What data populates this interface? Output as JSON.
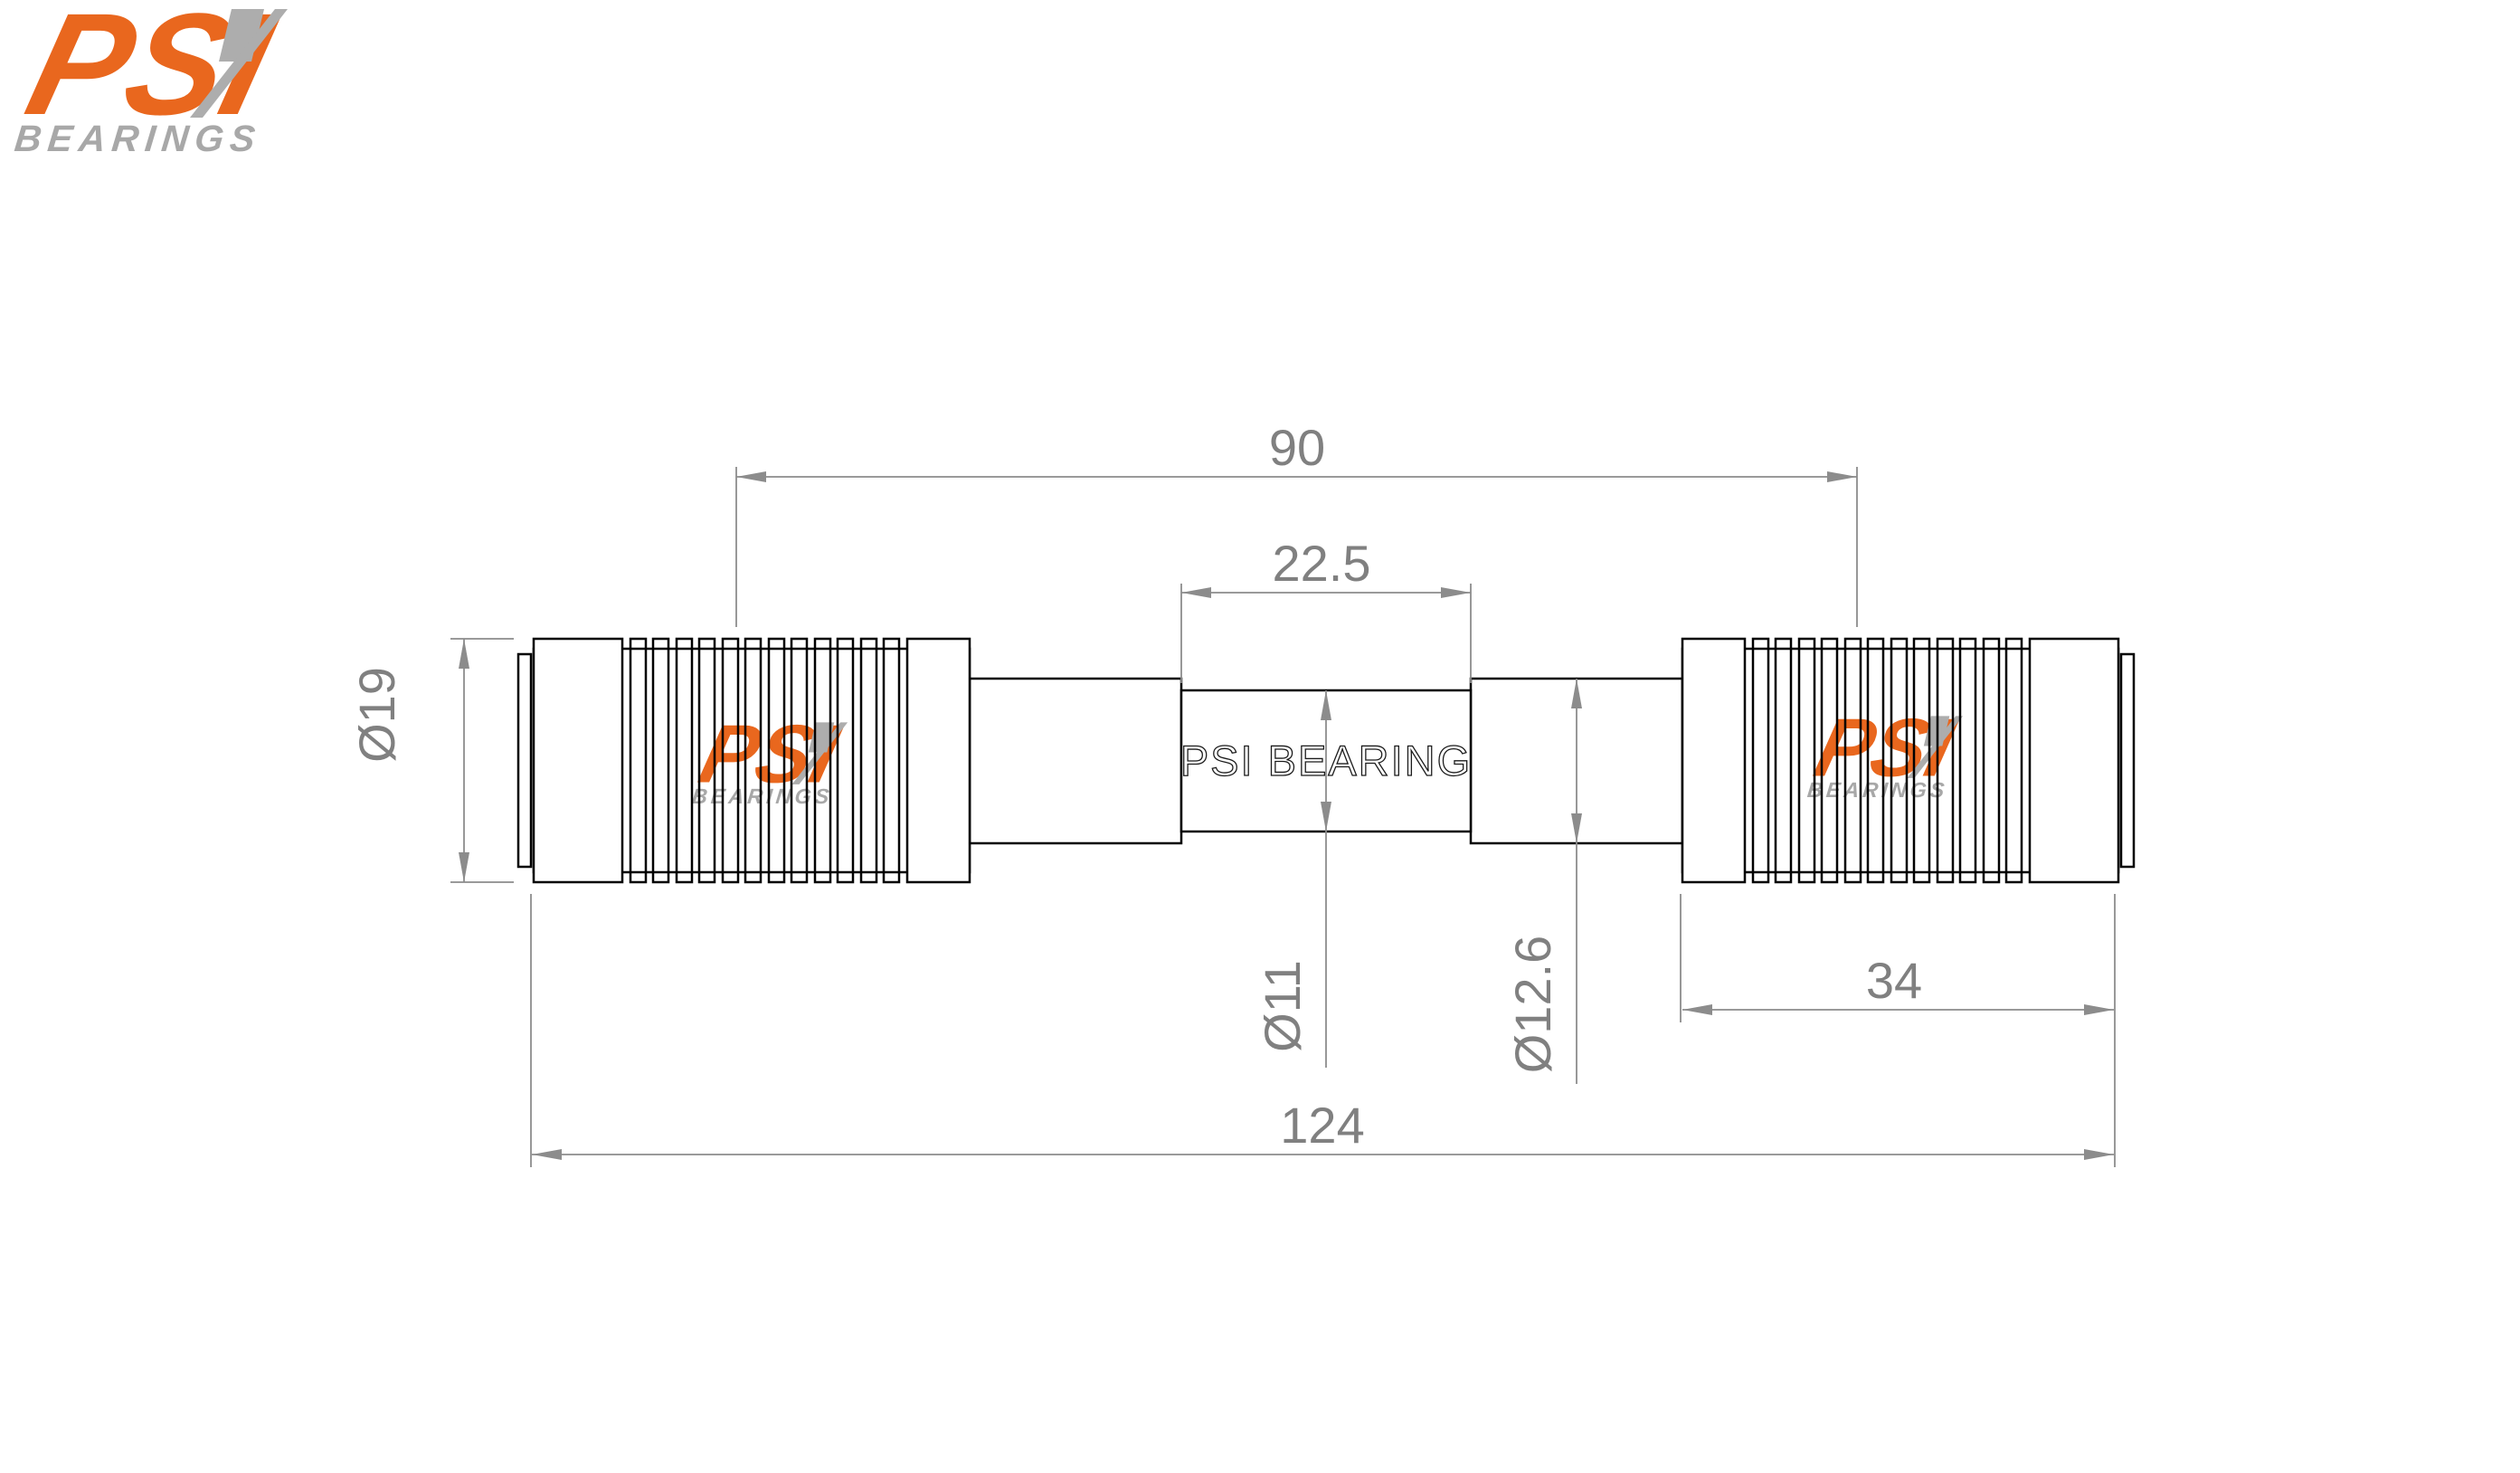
{
  "brand": {
    "name_psi": "PSI",
    "name_bearings": "BEARINGS",
    "orange": "#E9671E",
    "gray": "#A8A8A8"
  },
  "drawing": {
    "part_label": "PSI BEARING",
    "outline_color": "#000000",
    "dim_color": "#8C8C8C",
    "dim_text_color": "#808080",
    "dims": {
      "bearing_span": "90",
      "center_length": "22.5",
      "bearing_od": "Ø19",
      "center_od": "Ø11",
      "shaft_od": "Ø12.6",
      "bearing_length": "34",
      "overall_length": "124"
    }
  }
}
